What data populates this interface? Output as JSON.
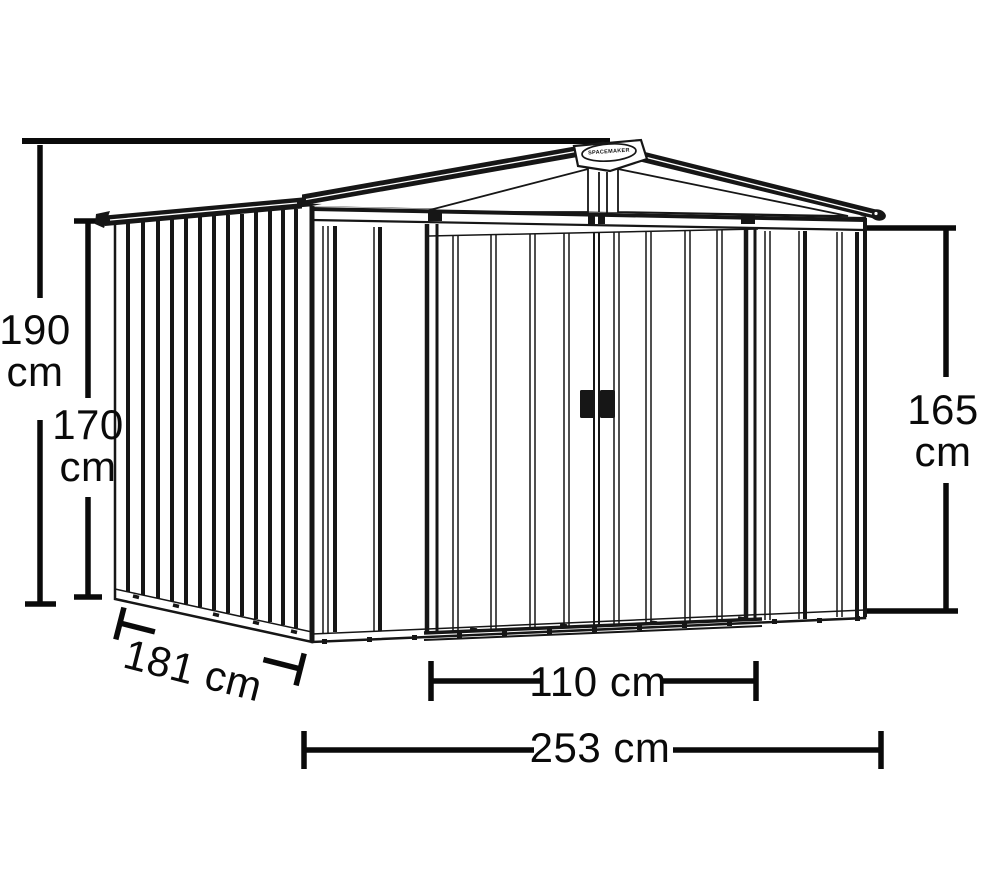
{
  "diagram": {
    "brand_badge": {
      "text": "SPACEMAKER"
    },
    "dimensions": {
      "overall_height": {
        "value": "190",
        "unit": "cm"
      },
      "wall_height": {
        "value": "170",
        "unit": "cm"
      },
      "eave_height": {
        "value": "165",
        "unit": "cm"
      },
      "depth": {
        "value": "181",
        "unit": "cm",
        "text": "181 cm"
      },
      "door_width": {
        "value": "110",
        "unit": "cm",
        "text": "110 cm"
      },
      "overall_width": {
        "value": "253",
        "unit": "cm",
        "text": "253 cm"
      }
    },
    "line_color": "#161616",
    "background_color": "#ffffff"
  }
}
